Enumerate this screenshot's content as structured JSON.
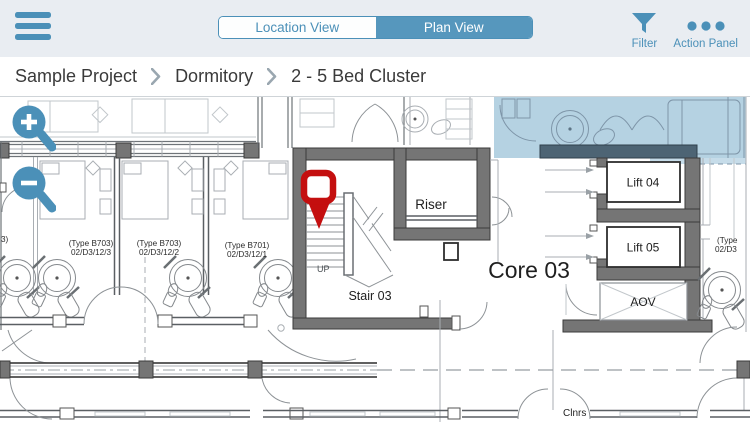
{
  "topbar": {
    "segmented": {
      "options": [
        {
          "label": "Location View",
          "selected": false
        },
        {
          "label": "Plan View",
          "selected": true
        }
      ]
    },
    "filter": {
      "label": "Filter"
    },
    "action_panel": {
      "label": "Action Panel"
    }
  },
  "breadcrumb": {
    "items": [
      "Sample Project",
      "Dormitory",
      "2 - 5 Bed Cluster"
    ]
  },
  "plan": {
    "rooms": {
      "riser": "Riser",
      "stair_up": "UP",
      "stair": "Stair 03",
      "core": "Core 03",
      "lift04": "Lift 04",
      "lift05": "Lift 05",
      "aov": "AOV",
      "cleaners_partial": "Clnrs"
    },
    "unit_labels": [
      {
        "line1": "(Type B703)",
        "line2": "02/D3/12/3"
      },
      {
        "line1": "(Type B703)",
        "line2": "02/D3/12/2"
      },
      {
        "line1": "(Type B701)",
        "line2": "02/D3/12/1"
      },
      {
        "line1": "(Type",
        "line2": "02/D3"
      },
      {
        "line1": "3)",
        "line2": ""
      }
    ]
  },
  "colors": {
    "accent": "#4b90b8",
    "topbar_bg": "#e9edf2",
    "selection_highlight": "rgba(91,155,191,0.45)",
    "wall_gray": "#757575",
    "pin_red": "#c40f0f"
  }
}
